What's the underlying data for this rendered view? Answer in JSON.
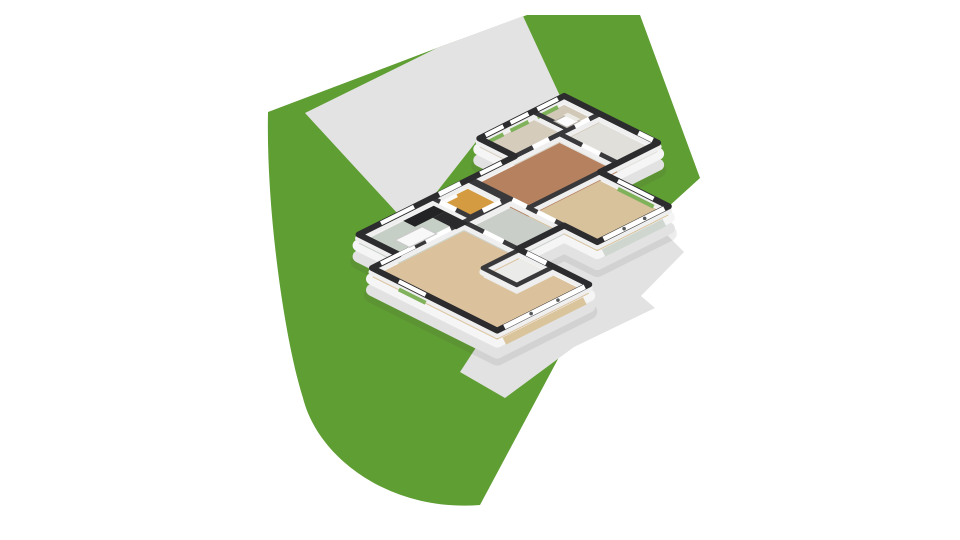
{
  "scene": {
    "description": "3D dollhouse floor plan of a single-storey house on a green landscaped plot with driveway and terrace",
    "canvas": {
      "width": 960,
      "height": 540,
      "background": "#ffffff"
    },
    "colors": {
      "grass": "#5f9e33",
      "driveway": "#e3e3e3",
      "terrace": "#e2e2e2",
      "wall_top_exterior": "#2c2c2f",
      "wall_top_interior": "#39393c",
      "wall_face": "#efefef",
      "facade_mid": "#f5f5f5",
      "facade_low": "#e2e2e2",
      "wall_gap_fill": "#f2f2f2",
      "shadow": "rgba(70,70,70,0.10)",
      "window_glass": "#ffffff",
      "window_green": "#7fb25a",
      "door_leaf": "#ffffff",
      "glass_divider": "#55585a",
      "door_lower_band": "#d9c49c",
      "glass_lower_band": "#cfd6cf",
      "threshold": "#fafafa"
    },
    "ground": {
      "grass": {
        "name": "grass-plot",
        "path": "M268,112 L437,48 L527,15 L640,15 L700,178 L612,258 L480,505 C390,512 318,458 303,398 C284,338 266,208 268,112 Z"
      },
      "driveway": {
        "name": "driveway",
        "path": "M305,113 L437,48 L523,16 L560,96 L479,138 L432,198 L398,214 Z"
      },
      "terrace": {
        "name": "terrace-path",
        "path": "M556,225 L662,230 L684,252 L641,296 L655,308 L574,347 L505,398 L460,372 Z"
      }
    },
    "projection": {
      "matrix": [
        0.894,
        0.447,
        0.894,
        -0.447,
        372,
        268
      ],
      "floor_offset": 9,
      "face_offset": 4,
      "facade_mid_offset": 11,
      "facade_low_offset": 22,
      "shadow_offset": 27
    },
    "house": {
      "silhouette": [
        [
          0,
          0
        ],
        [
          140,
          0
        ],
        [
          140,
          103
        ],
        [
          60,
          103
        ],
        [
          60,
          155
        ],
        [
          97,
          155
        ],
        [
          97,
          235
        ],
        [
          20,
          235
        ],
        [
          20,
          300
        ],
        [
          -85,
          300
        ],
        [
          -85,
          205
        ],
        [
          -45,
          205
        ],
        [
          -45,
          30
        ],
        [
          0,
          30
        ]
      ],
      "rooms": [
        {
          "name": "living-room",
          "floor_color": "#dcc29c",
          "rect": [
            0,
            0,
            140,
            103
          ]
        },
        {
          "name": "kitchen",
          "floor_color": "#c6cfc5",
          "rect": [
            -45,
            30,
            0,
            112
          ]
        },
        {
          "name": "entry-hall",
          "floor_color": "#d49b41",
          "rect": [
            -45,
            112,
            -2,
            152
          ]
        },
        {
          "name": "hallway",
          "floor_color": "#c9cec9",
          "rect": [
            0,
            103,
            60,
            155
          ]
        },
        {
          "name": "closet",
          "floor_color": "#ebecea",
          "rect": [
            62,
            62,
            100,
            103
          ]
        },
        {
          "name": "bedroom-1",
          "floor_color": "#b5815f",
          "rect": [
            -45,
            155,
            20,
            255
          ]
        },
        {
          "name": "dining-room",
          "floor_color": "#d8c29b",
          "rect": [
            20,
            155,
            97,
            235
          ]
        },
        {
          "name": "bedroom-2",
          "floor_color": "#d5ccbc",
          "rect": [
            -85,
            205,
            -45,
            265
          ]
        },
        {
          "name": "bathroom",
          "floor_color": "#d2c8b8",
          "rect": [
            -85,
            265,
            -45,
            300
          ]
        },
        {
          "name": "utility-room",
          "floor_color": "#e1dfda",
          "rect": [
            -45,
            255,
            20,
            300
          ]
        }
      ],
      "windows": [
        {
          "name": "window-living-nw",
          "seg": [
            0,
            10,
            0,
            48
          ],
          "green": false
        },
        {
          "name": "window-living-sw",
          "seg": [
            30,
            0,
            60,
            0
          ],
          "green": true
        },
        {
          "name": "window-kitchen-nw",
          "seg": [
            -45,
            55,
            -45,
            92
          ],
          "green": false
        },
        {
          "name": "window-bedroom1-nw",
          "seg": [
            -45,
            166,
            -45,
            190
          ],
          "green": false
        },
        {
          "name": "window-bedroom2-nw-1",
          "seg": [
            -85,
            212,
            -85,
            232
          ],
          "green": true
        },
        {
          "name": "window-bedroom2-nw-2",
          "seg": [
            -85,
            240,
            -85,
            260
          ],
          "green": true
        },
        {
          "name": "window-bathroom-nw",
          "seg": [
            -85,
            270,
            -85,
            293
          ],
          "green": true
        },
        {
          "name": "window-dining-ne",
          "seg": [
            40,
            235,
            80,
            235
          ],
          "green": true
        }
      ],
      "exterior_doors": [
        {
          "name": "front-door",
          "seg": [
            -45,
            120,
            -45,
            144
          ]
        },
        {
          "name": "utility-rear-door",
          "seg": [
            -2,
            300,
            14,
            300
          ]
        }
      ],
      "glass_doors": [
        {
          "name": "sliding-doors-living-front",
          "seg": [
            140,
            8,
            140,
            98
          ],
          "dividers": [
            38,
            68
          ],
          "lower_band": "door_lower_band"
        },
        {
          "name": "glass-doors-dining-se",
          "seg": [
            97,
            162,
            97,
            230
          ],
          "dividers": [
            185,
            208
          ],
          "lower_band": "glass_lower_band"
        }
      ],
      "interior_doors": [
        {
          "name": "door-kitchen-living",
          "seg": [
            0,
            60,
            0,
            88
          ]
        },
        {
          "name": "door-hall-living",
          "seg": [
            22,
            103,
            44,
            103
          ]
        },
        {
          "name": "door-closet-hall",
          "seg": [
            70,
            103,
            92,
            103
          ]
        },
        {
          "name": "door-entry-kitchen",
          "seg": [
            -36,
            112,
            -18,
            112
          ]
        },
        {
          "name": "door-entry-hall",
          "seg": [
            -2,
            126,
            -2,
            146
          ]
        },
        {
          "name": "door-hall-dining",
          "seg": [
            30,
            155,
            50,
            155
          ]
        },
        {
          "name": "door-hall-bedroom1",
          "seg": [
            2,
            155,
            18,
            155
          ]
        },
        {
          "name": "door-bedroom1-bedroom2",
          "seg": [
            -45,
            225,
            -45,
            243
          ]
        },
        {
          "name": "door-utility-bathroom",
          "seg": [
            -45,
            272,
            -45,
            288
          ]
        },
        {
          "name": "door-bedroom1-utility",
          "seg": [
            -20,
            255,
            0,
            255
          ]
        }
      ],
      "furniture": [
        {
          "name": "kitchen-cabinet-tall",
          "rect": [
            -43,
            78,
            -30,
            112
          ],
          "color": "#232325",
          "stroke": "none"
        },
        {
          "name": "kitchen-cabinet-run",
          "rect": [
            -30,
            98,
            -4,
            112
          ],
          "color": "#2a2a2c",
          "stroke": "none"
        },
        {
          "name": "kitchen-island",
          "rect": [
            -26,
            52,
            -10,
            82
          ],
          "color": "#f8f8f8",
          "stroke": "#c9c9c9"
        },
        {
          "name": "toilet",
          "rect": [
            -70,
            274,
            -56,
            288
          ],
          "color": "#fdfdfd",
          "stroke": "#b9b4aa"
        },
        {
          "name": "toilet-tank",
          "rect": [
            -72,
            286,
            -58,
            291
          ],
          "color": "#eceae5",
          "stroke": "none"
        }
      ],
      "entry_threshold": {
        "name": "entry-step",
        "seg": [
          -52,
          118,
          -52,
          146
        ]
      }
    }
  }
}
